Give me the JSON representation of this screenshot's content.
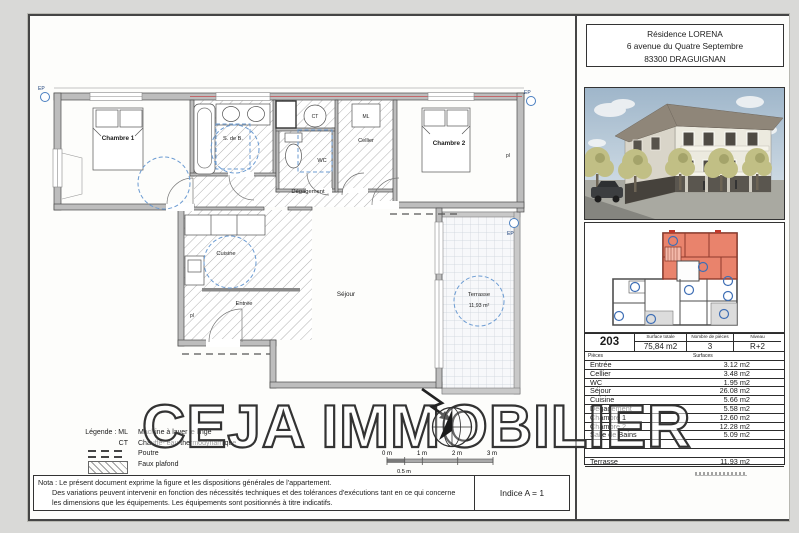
{
  "watermark": "CEJA IMMOBILIER",
  "address": {
    "line1": "Résidence LORENA",
    "line2": "6 avenue du Quatre Septembre",
    "line3": "83300 DRAGUIGNAN"
  },
  "plan": {
    "chambre1": "Chambre 1",
    "sdb": "S. de B.",
    "ct": "CT",
    "wc": "WC",
    "cellier": "Cellier",
    "ml": "ML",
    "chambre2": "Chambre 2",
    "pl": "pl",
    "degagement": "Dégagement",
    "cuisine": "Cuisine",
    "entree": "Entrée",
    "sejour": "Séjour",
    "terrasse": "Terrasse",
    "terrasse_area": "11,93 m²",
    "ep": "EP"
  },
  "legend": {
    "title": "Légende : ML",
    "ml_desc": "Machine à laver le linge",
    "ct_label": "CT",
    "ct_desc": "Chauffe- eau thermodynamique",
    "poutre": "Poutre",
    "faux_plafond": "Faux plafond"
  },
  "scale": {
    "t0": "0 m",
    "t1": "1 m",
    "t2": "2 m",
    "t3": "3 m",
    "half": "0.5 m"
  },
  "nota": {
    "line1": "Nota : Le présent document exprime la figure et les dispositions générales de l'appartement.",
    "line2": "Des variations peuvent intervenir en fonction des nécessités techniques et des tolérances d'exécutions tant en ce qui concerne",
    "line3": "les dimensions que les équipements. Les équipements sont positionnés à titre indicatifs.",
    "indice": "Indice A = 1"
  },
  "unit_table": {
    "unit": "203",
    "surface_totale_label": "Surface totale",
    "surface_totale": "75,84 m2",
    "nb_pieces_label": "Nombre de pièces",
    "nb_pieces": "3",
    "niveau_label": "Niveau",
    "niveau": "R+2",
    "col_pieces": "Pièces",
    "col_surfaces": "Surfaces",
    "rows": [
      {
        "piece": "Entrée",
        "surface": "3.12 m2"
      },
      {
        "piece": "Cellier",
        "surface": "3.48 m2"
      },
      {
        "piece": "WC",
        "surface": "1.95 m2"
      },
      {
        "piece": "Séjour",
        "surface": "26.08 m2"
      },
      {
        "piece": "Cuisine",
        "surface": "5.66 m2"
      },
      {
        "piece": "Dégagement",
        "surface": "5.58 m2"
      },
      {
        "piece": "Chambre 1",
        "surface": "12.60 m2"
      },
      {
        "piece": "Chambre 2",
        "surface": "12.28 m2"
      },
      {
        "piece": "Salle de Bains",
        "surface": "5.09 m2"
      },
      {
        "piece": "",
        "surface": ""
      },
      {
        "piece": "",
        "surface": ""
      },
      {
        "piece": "Terrasse",
        "surface": "11.93 m2"
      }
    ]
  },
  "colors": {
    "highlight": "#e9836c",
    "blue_marker": "#4a7fc0",
    "wall": "#bdbdbd"
  }
}
